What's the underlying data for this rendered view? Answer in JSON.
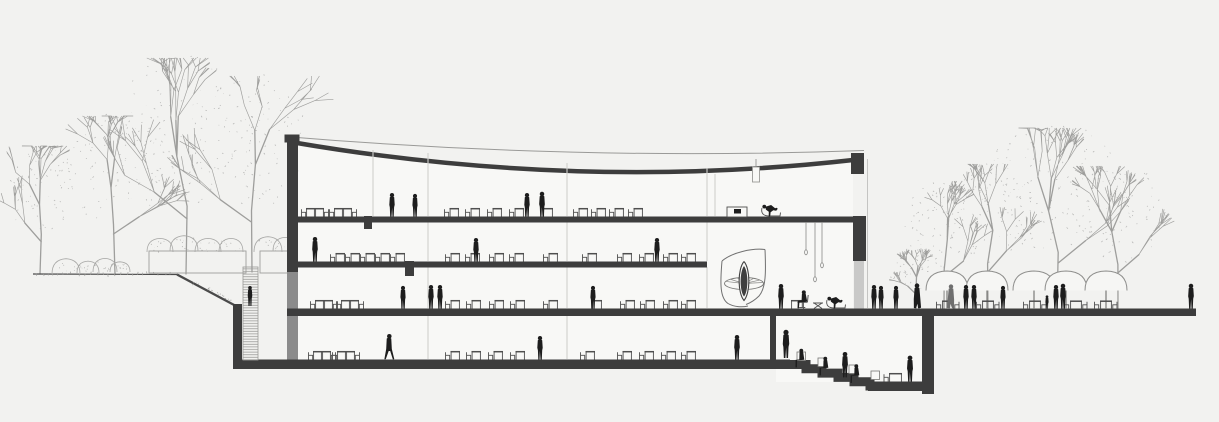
{
  "scene": {
    "width": 1219,
    "height": 422,
    "colors": {
      "bg": "#f2f2f0",
      "interior": "#f8f8f6",
      "ink": "#3d3d3d",
      "inkDark": "#1e1e1e",
      "wallGray": "#8b8b8b",
      "glass": "#c9c9c8",
      "lineLight": "#c4c4c2",
      "tree": "#9e9e9c",
      "speck": "#a6a6a4",
      "furn": "#4f4f4f",
      "person": "#1d1d1d",
      "personGray": "#6e6e6e",
      "hatch": "#9c9c9a",
      "outline": "#8f8f8d"
    },
    "building": {
      "roof_thin": "M284.5,136.5 Q578,161 864,150.5",
      "roof_thick": "M294,142.5 Q578,191 853,160",
      "interior_poly": "M298,146 Q578,192 853,163 L853,308 L298,308 Z",
      "basement_fill": [
        298,
        316,
        474,
        44
      ],
      "sunken_fill": [
        776,
        316,
        146,
        66
      ],
      "left_cap": [
        284.5,
        134.5,
        15,
        8
      ],
      "left_wall": [
        287,
        140,
        11,
        132
      ],
      "left_wall_lower": [
        287,
        272,
        11,
        89
      ],
      "right_cap": [
        851,
        153,
        13,
        21
      ],
      "right_wall": [
        853,
        216,
        13,
        45
      ],
      "right_glass": [
        854,
        261,
        10,
        48
      ],
      "skin_line": [
        867.5,
        159,
        867.5,
        308
      ],
      "slab1": [
        287,
        216.5,
        579,
        6
      ],
      "slab2": [
        287,
        261.5,
        420,
        6
      ],
      "ground_slab": [
        287,
        308.5,
        909,
        7.5
      ],
      "bottom_slab": [
        233,
        359.5,
        557,
        9.5
      ],
      "ret_wall": [
        233,
        304,
        9,
        60
      ],
      "divider_wall": [
        770,
        316,
        6,
        45
      ],
      "deep_wall": [
        922,
        314,
        12,
        80
      ],
      "deep_floor": [
        868,
        381.5,
        60,
        9.5
      ],
      "steps_path": "M790,364.5 H806 V368.8 H822 V373.1 H838 V377.4 H854 V381.7 H870 V386 H930",
      "stubs": [
        [
          364,
          216,
          8,
          13
        ],
        [
          405,
          261,
          9,
          15
        ]
      ],
      "columns": [
        [
          373,
          150,
          216
        ],
        [
          715,
          174,
          216
        ],
        [
          428,
          153,
          216
        ],
        [
          428,
          222,
          261
        ],
        [
          428,
          267,
          308
        ],
        [
          428,
          316,
          359
        ],
        [
          567,
          163,
          216
        ],
        [
          567,
          222,
          261
        ],
        [
          567,
          267,
          308
        ],
        [
          567,
          316,
          359
        ],
        [
          707,
          168,
          216
        ],
        [
          707,
          222,
          261
        ],
        [
          707,
          267,
          308
        ]
      ],
      "stair_hatch": [
        243,
        267,
        15,
        93
      ]
    },
    "ground": {
      "left_line": [
        33,
        274,
        177,
        274.5
      ],
      "slope": [
        177,
        274.5,
        236,
        306
      ],
      "hedge_boxes": [
        [
          149,
          251,
          97,
          22
        ],
        [
          260,
          251,
          30,
          22
        ]
      ],
      "slope_tufts": [
        [
          196,
          283
        ],
        [
          208,
          289
        ],
        [
          219,
          295
        ],
        [
          229,
          300
        ]
      ]
    },
    "trees": [
      {
        "x": 40,
        "base": 274,
        "top": 150,
        "spread": 34,
        "seed": 1
      },
      {
        "x": 115,
        "base": 274,
        "top": 120,
        "spread": 52,
        "seed": 2
      },
      {
        "x": 186,
        "base": 274,
        "top": 62,
        "spread": 72,
        "seed": 3
      },
      {
        "x": 252,
        "base": 272,
        "top": 80,
        "spread": 55,
        "seed": 4
      },
      {
        "x": 916,
        "base": 309,
        "top": 252,
        "spread": 26,
        "seed": 5
      },
      {
        "x": 944,
        "base": 309,
        "top": 185,
        "spread": 40,
        "seed": 6
      },
      {
        "x": 988,
        "base": 309,
        "top": 168,
        "spread": 46,
        "seed": 7
      },
      {
        "x": 1057,
        "base": 309,
        "top": 132,
        "spread": 78,
        "seed": 8
      },
      {
        "x": 1118,
        "base": 309,
        "top": 170,
        "spread": 52,
        "seed": 9
      }
    ],
    "bushes": [
      [
        66,
        274,
        14,
        9
      ],
      [
        88,
        273,
        11,
        7
      ],
      [
        105,
        272,
        12,
        8
      ],
      [
        120,
        272,
        10,
        6
      ],
      [
        160,
        252,
        13,
        8
      ],
      [
        184,
        251,
        14,
        9
      ],
      [
        208,
        252,
        13,
        8
      ],
      [
        231,
        252,
        12,
        8
      ],
      [
        268,
        252,
        14,
        9
      ],
      [
        285,
        251,
        12,
        8
      ]
    ],
    "spiral": {
      "shell_left": "M722,261 C720,284 720,298 728,303.5 C734,307 742,307.5 748,306",
      "shell_right": "M765,249.5 C766,272 766,288 759,296 C754,301 750,303 746,304.5",
      "top_arc": "M722,261 C732,252.5 752,248 765,249.5",
      "disk": [
        744,
        283.5,
        19.5,
        6
      ],
      "leaf_outer": "M744,261.5 C750.5,269 750.5,293 744,300.5 C737.5,293 737.5,269 744,261.5",
      "leaf_inner": "M744,266 C748.5,272 748.5,291 744,296.5 C739.5,291 739.5,272 744,266"
    },
    "pendants": {
      "lines": [
        [
          806,
          222,
          250
        ],
        [
          815,
          222,
          277
        ],
        [
          822,
          222,
          263
        ]
      ],
      "lamp_rect": [
        752.5,
        167,
        7,
        15
      ],
      "lamp_line": [
        756,
        159,
        167
      ]
    },
    "desks": {
      "floors": [
        {
          "y": 216.5,
          "pairs": [
            301,
            329
          ],
          "singles": [
            444,
            465,
            487,
            509,
            573,
            591,
            609,
            628
          ],
          "tables": [
            543
          ]
        },
        {
          "y": 261.5,
          "pairs": [],
          "singles": [
            330,
            345,
            360,
            375,
            390,
            445,
            465,
            489,
            509,
            543,
            582,
            617,
            639,
            663,
            681
          ],
          "tables": []
        },
        {
          "y": 308.5,
          "pairs": [
            310,
            336
          ],
          "singles": [
            445,
            466,
            489,
            510,
            543,
            620,
            640,
            663,
            681
          ],
          "tables": [
            592
          ]
        },
        {
          "y": 359.5,
          "pairs": [
            308,
            332
          ],
          "singles": [
            445,
            466,
            488,
            510,
            580,
            617,
            639,
            661,
            681
          ],
          "tables": []
        }
      ]
    },
    "lounge_f1": {
      "cabinet": [
        727,
        207,
        20,
        10
      ],
      "item": [
        734,
        209,
        7,
        4.5
      ],
      "xstool": [
        753,
        216.5
      ],
      "chaise_x": 773
    },
    "atrium_furniture": {
      "table": [
        791,
        308.5,
        13
      ],
      "xstool": [
        818,
        308.5
      ],
      "chaise_x": 838
    },
    "deep_table": [
      889,
      381.5,
      13
    ],
    "cubes": [
      [
        797,
        352,
        8.5
      ],
      [
        818,
        358,
        8.5
      ],
      [
        849,
        365,
        8.5
      ],
      [
        871,
        371,
        8.5
      ]
    ],
    "umbrellas": {
      "cx": [
        947,
        987,
        1034,
        1066,
        1106
      ],
      "top": 271,
      "rim": 290.5,
      "half": 21,
      "pole_bottom": 309
    },
    "cafe_sets": [
      936,
      976,
      1023,
      1064,
      1094
    ],
    "people": [
      [
        "stand",
        392,
        216.5,
        1.0,
        "person",
        0
      ],
      [
        "stand",
        415,
        216.5,
        0.96,
        "person",
        1
      ],
      [
        "stand",
        527,
        216.5,
        1.0,
        "person",
        0
      ],
      [
        "stand",
        542,
        216.5,
        1.05,
        "person",
        1
      ],
      [
        "recline",
        773,
        216.5,
        1.0,
        "person",
        0
      ],
      [
        "stand",
        315,
        261.5,
        1.04,
        "person",
        0
      ],
      [
        "stand",
        476,
        261.5,
        1.0,
        "person",
        1
      ],
      [
        "stand",
        657,
        261.5,
        1.0,
        "person",
        0
      ],
      [
        "stand",
        403,
        308.5,
        0.96,
        "person",
        1
      ],
      [
        "stand",
        431,
        308.5,
        1.0,
        "person",
        0
      ],
      [
        "stand",
        440,
        308.5,
        1.0,
        "person",
        1
      ],
      [
        "stand",
        593,
        308.5,
        0.96,
        "person",
        0
      ],
      [
        "stand",
        250,
        306,
        0.85,
        "person",
        0
      ],
      [
        "stand",
        781,
        308.5,
        1.04,
        "person",
        0
      ],
      [
        "sitchair",
        806,
        308.5,
        1.0,
        "person",
        0
      ],
      [
        "recline",
        838,
        308.5,
        1.0,
        "person",
        0
      ],
      [
        "stand",
        874,
        308.5,
        1.0,
        "person",
        0
      ],
      [
        "stand",
        881,
        308.5,
        0.96,
        "person",
        1
      ],
      [
        "stand",
        896,
        308.5,
        0.96,
        "person",
        0
      ],
      [
        "coat",
        917,
        308.5,
        1.04,
        "person",
        0
      ],
      [
        "coat",
        951,
        308.5,
        1.0,
        "personGray",
        1
      ],
      [
        "stand",
        966,
        308.5,
        1.0,
        "person",
        0
      ],
      [
        "stand",
        974,
        308.5,
        1.0,
        "person",
        1
      ],
      [
        "stand",
        1003,
        308.5,
        0.96,
        "person",
        0
      ],
      [
        "child",
        1047,
        308.5,
        0.55,
        "person",
        0
      ],
      [
        "stand",
        1056,
        308.5,
        1.0,
        "person",
        0
      ],
      [
        "stand",
        1063,
        308.5,
        1.05,
        "person",
        1
      ],
      [
        "stand",
        1191,
        308.5,
        1.05,
        "person",
        0
      ],
      [
        "walk",
        389,
        359.5,
        1.08,
        "person",
        0
      ],
      [
        "stand",
        540,
        359.5,
        1.0,
        "person",
        1
      ],
      [
        "stand",
        737,
        359.5,
        1.04,
        "person",
        0
      ],
      [
        "stand",
        786,
        358,
        1.2,
        "person",
        0
      ],
      [
        "stepsit",
        803,
        363,
        1.0,
        "person",
        0
      ],
      [
        "stepsit",
        827,
        371,
        1.0,
        "person",
        0
      ],
      [
        "stand",
        845,
        377.4,
        1.08,
        "person",
        0
      ],
      [
        "stepsit",
        858,
        378.5,
        1.0,
        "person",
        0
      ],
      [
        "stand",
        910,
        381.5,
        1.1,
        "person",
        1
      ]
    ]
  }
}
